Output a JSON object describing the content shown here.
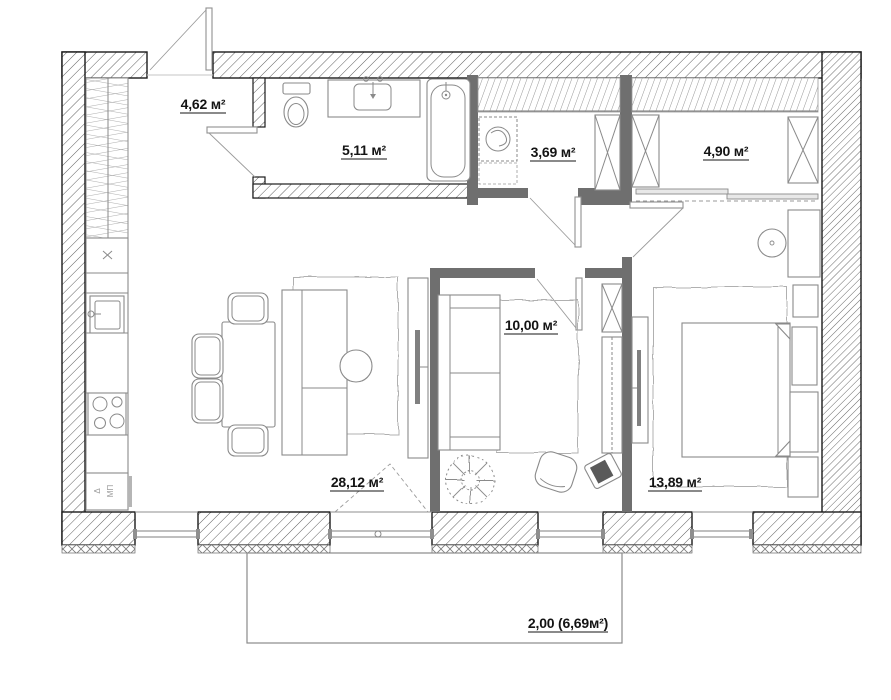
{
  "plan": {
    "rooms": [
      {
        "id": "hallway",
        "area_label": "4,62 м²"
      },
      {
        "id": "bathroom",
        "area_label": "5,11 м²"
      },
      {
        "id": "wardrobe-small",
        "area_label": "3,69 м²"
      },
      {
        "id": "wardrobe-large",
        "area_label": "4,90 м²"
      },
      {
        "id": "room-10",
        "area_label": "10,00 м²"
      },
      {
        "id": "living-kitchen",
        "area_label": "28,12 м²"
      },
      {
        "id": "bedroom",
        "area_label": "13,89 м²"
      }
    ],
    "balcony": {
      "dimension_label": "2,00 (6,69м²)"
    },
    "kitchen_appliance": {
      "marker": "Δ",
      "code": "МП"
    },
    "colors": {
      "background": "#ffffff",
      "wall_outline": "#1b1b1b",
      "partition": "#6f6f6f",
      "furniture_line": "#8a8a8a",
      "text": "#141414"
    }
  }
}
